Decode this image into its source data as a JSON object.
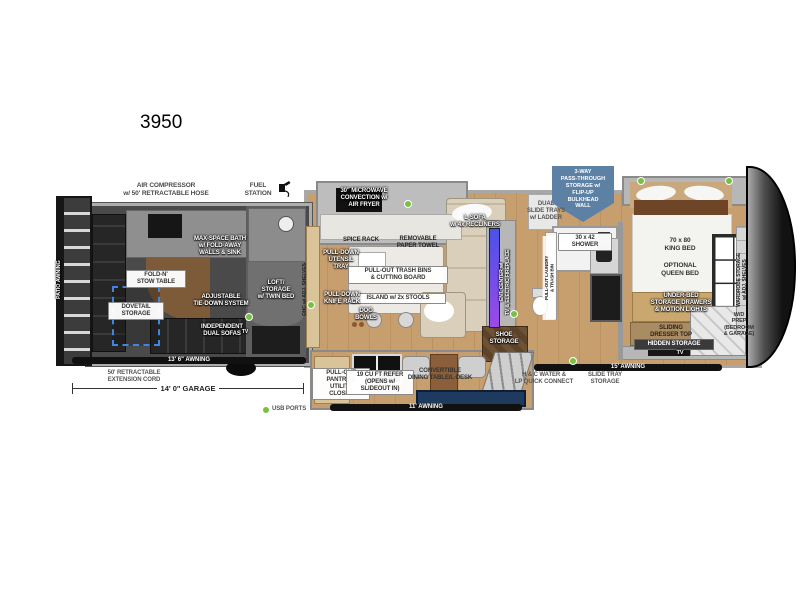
{
  "model": "3950",
  "colors": {
    "badge_blue": "#5d81a5",
    "usb_green": "#76c043",
    "awning_black": "#111111",
    "wood_floor": "#c79e6e",
    "garage_gray": "#4a4a4a",
    "tv_screen_top": "#4a52e8",
    "tv_screen_bottom": "#9a4ae8"
  },
  "legend": {
    "usb": "USB PORTS"
  },
  "exterior": {
    "patio_awning": "PATIO AWNING",
    "air_compressor": "AIR COMPRESSOR\nw/ 50' RETRACTABLE HOSE",
    "fuel_station": "FUEL\nSTATION",
    "garage_awning": "13' 6\" AWNING",
    "extension_cord": "50' RETRACTABLE\nEXTENSION CORD",
    "garage_length": "14' 0\" GARAGE",
    "main_awning": "11' AWNING",
    "bedroom_awning": "15' AWNING",
    "hc_water": "H & C WATER &\nLP QUICK CONNECT",
    "slide_tray_storage": "SLIDE TRAY\nSTORAGE",
    "pass_through": "3-WAY\nPASS-THROUGH\nSTORAGE w/\nFLIP-UP\nBULKHEAD\nWALL",
    "dual_slide_trays": "DUAL\nSLIDE TRAYS\nw/ LADDER"
  },
  "garage": {
    "max_space_bath": "MAX-SPACE BATH\nw/ FOLD-AWAY\nWALLS & SINK",
    "fold_n_stow": "FOLD-N'\nSTOW TABLE",
    "adjustable_tie_down": "ADJUSTABLE\nTIE-DOWN SYSTEM",
    "dovetail_storage": "DOVETAIL\nSTORAGE",
    "independent_sofas": "INDEPENDENT\nDUAL SOFAS",
    "tv": "TV",
    "loft": "LOFT/\nSTORAGE\nw/ TWIN BED"
  },
  "kitchen": {
    "ohc": "OHC w/ ADJ. SHELVES",
    "microwave": "30\" MICROWAVE\nCONVECTION w/\nAIR FRYER",
    "spice_rack": "SPICE RACK",
    "paper_towel": "REMOVABLE\nPAPER TOWEL",
    "utensil_tray": "PULL-DOWN\nUTENSIL\nTRAY",
    "trash_bins": "PULL-OUT TRASH BINS\n& CUTTING BOARD",
    "island": "ISLAND w/ 2x STOOLS",
    "knife_rack": "PULL-DOWN\nKNIFE RACK",
    "dog_bowls": "DOG\nBOWLS",
    "pantry": "PULL-OUT\nPANTRY &\nUTILITY\nCLOSET",
    "refer": "19 CU FT REFER\n(OPENS w/\nSLIDEOUT IN)",
    "dining": "CONVERTIBLE\nDINING TABLE/L-DESK"
  },
  "living": {
    "l_sofa": "L-SOFA\nw/ 4x RECLINERS",
    "ent_center": "ENT. CENTER w/\nTV & ELECTRIC FIREPLACE",
    "shoe_storage": "SHOE\nSTORAGE"
  },
  "bath": {
    "shower": "30 x 42\nSHOWER",
    "laundry": "PULL-OUT LAUNDRY\n& TRASH BIN"
  },
  "bedroom": {
    "king_bed": "70 x 80\nKING BED",
    "optional_queen": "OPTIONAL\nQUEEN BED",
    "under_bed": "UNDER-BED\nSTORAGE DRAWERS\n& MOTION LIGHTS",
    "sliding_dresser": "SLIDING\nDRESSER TOP",
    "hidden_storage": "HIDDEN STORAGE",
    "tv": "TV",
    "wardrobe": "WARDROBE STORAGE\nw/ ADJ. SHELVES",
    "wd_prep": "W/D\nPREP\n(BEDROOM\n& GARAGE)"
  }
}
